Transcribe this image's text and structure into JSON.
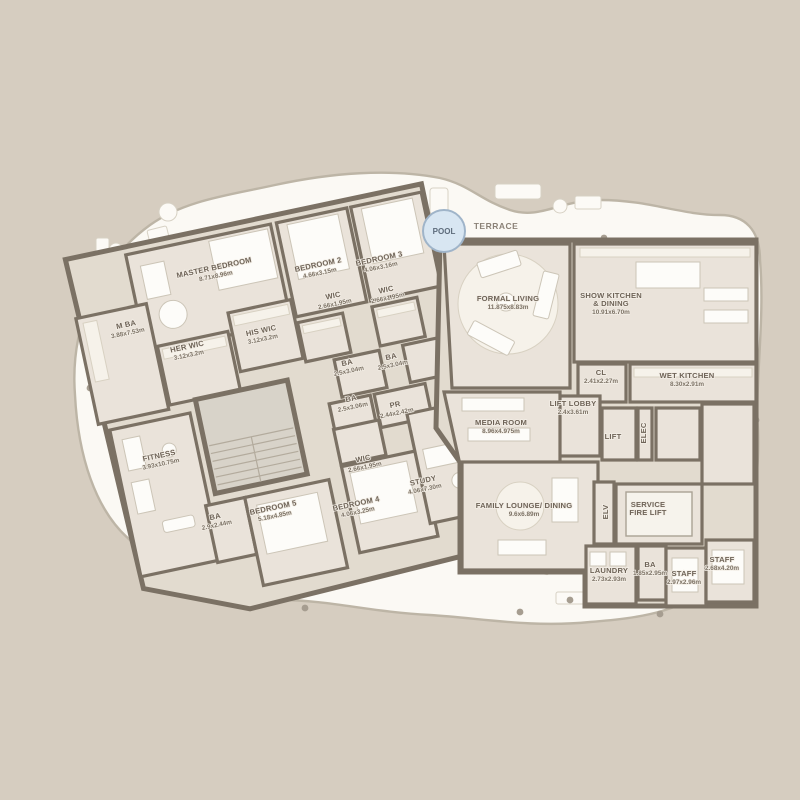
{
  "title": "Penthouse floor plan",
  "colors": {
    "background": "#d6cdc0",
    "terrace_fill": "#fbf9f4",
    "plan_room_fill": "#eae3da",
    "corridor_fill": "#e2dbcf",
    "wall": "#7b7164",
    "pool_fill": "#d8e6f2",
    "pool_stroke": "#9fb4c9",
    "label_text": "#6e6357"
  },
  "rooms": [
    {
      "id": "master-bedroom",
      "name": "MASTER BEDROOM",
      "dims": "8.71x8.96m"
    },
    {
      "id": "bedroom-2",
      "name": "BEDROOM 2",
      "dims": "4.66x3.15m"
    },
    {
      "id": "bedroom-3",
      "name": "BEDROOM 3",
      "dims": "4.06x3.16m"
    },
    {
      "id": "wic-bedroom-2",
      "name": "WIC",
      "dims": "2.66x1.95m"
    },
    {
      "id": "wic-bedroom-3",
      "name": "WIC",
      "dims": "2.66x1.95m"
    },
    {
      "id": "master-bath",
      "name": "M BA",
      "dims": "3.88x7.53m"
    },
    {
      "id": "his-wic",
      "name": "HIS WIC",
      "dims": "3.12x3.2m"
    },
    {
      "id": "her-wic",
      "name": "HER WIC",
      "dims": "3.12x3.2m"
    },
    {
      "id": "ba-bedroom-2",
      "name": "BA",
      "dims": "2.5x3.04m"
    },
    {
      "id": "ba-bedroom-3",
      "name": "BA",
      "dims": "2.5x3.04m"
    },
    {
      "id": "ba-hall",
      "name": "BA",
      "dims": "2.5x3.06m"
    },
    {
      "id": "powder-room",
      "name": "PR",
      "dims": "2.44x2.42m"
    },
    {
      "id": "fitness",
      "name": "FITNESS",
      "dims": "3.93x10.75m"
    },
    {
      "id": "wic-bedroom-4",
      "name": "WIC",
      "dims": "2.66x1.95m"
    },
    {
      "id": "study",
      "name": "STUDY",
      "dims": "4.06x7.30m"
    },
    {
      "id": "ba-bedroom-5",
      "name": "BA",
      "dims": "2.9x2.44m"
    },
    {
      "id": "bedroom-5",
      "name": "BEDROOM 5",
      "dims": "5.18x4.85m"
    },
    {
      "id": "bedroom-4",
      "name": "BEDROOM 4",
      "dims": "4.06x3.25m"
    },
    {
      "id": "formal-living",
      "name": "FORMAL LIVING",
      "dims": "11.875x8.83m"
    },
    {
      "id": "show-kitchen",
      "name": "SHOW KITCHEN",
      "name2": "& DINING",
      "dims": "10.91x6.70m"
    },
    {
      "id": "closet",
      "name": "CL",
      "dims": "2.41x2.27m"
    },
    {
      "id": "wet-kitchen",
      "name": "WET KITCHEN",
      "dims": "8.30x2.91m"
    },
    {
      "id": "lift-lobby",
      "name": "LIFT LOBBY",
      "dims": "2.4x3.61m"
    },
    {
      "id": "media-room",
      "name": "MEDIA ROOM",
      "dims": "8.96x4.975m"
    },
    {
      "id": "family-lounge",
      "name": "FAMILY LOUNGE/ DINING",
      "dims": "9.6x6.89m"
    },
    {
      "id": "service-fire-lift",
      "name": "SERVICE",
      "name2": "FIRE LIFT"
    },
    {
      "id": "laundry",
      "name": "LAUNDRY",
      "dims": "2.73x2.93m"
    },
    {
      "id": "ba-staff",
      "name": "BA",
      "dims": "1.85x2.95m"
    },
    {
      "id": "staff-1",
      "name": "STAFF",
      "dims": "2.97x2.96m"
    },
    {
      "id": "staff-2",
      "name": "STAFF",
      "dims": "2.68x4.20m"
    },
    {
      "id": "lift",
      "name": "LIFT"
    },
    {
      "id": "elec",
      "name": "ELEC"
    },
    {
      "id": "elv",
      "name": "ELV"
    },
    {
      "id": "pool",
      "name": "POOL"
    },
    {
      "id": "terrace",
      "name": "TERRACE"
    }
  ]
}
